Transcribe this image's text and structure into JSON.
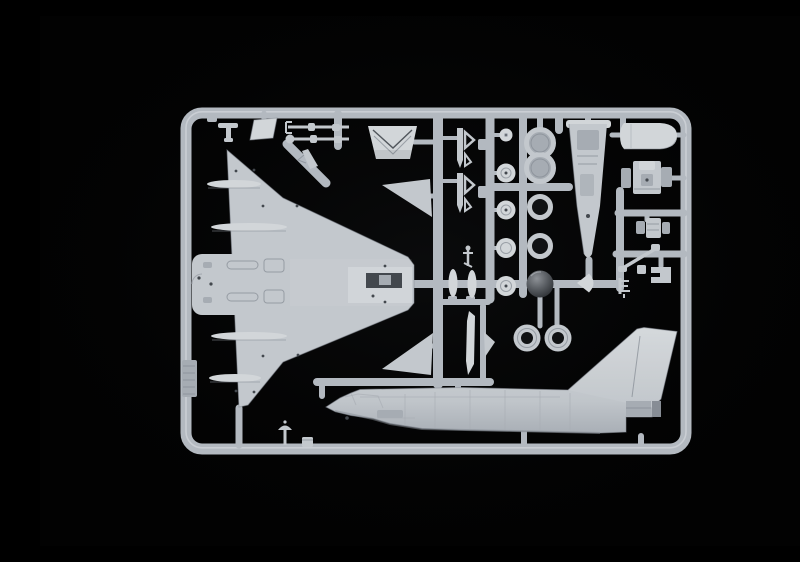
{
  "scene": {
    "description": "Macro photograph of a light grey injection-moulded plastic model-kit sprue (parts tree) for a delta-wing jet fighter, lying on a pitch-black studio background",
    "subject_hint": "Eurofighter-Typhoon-style kit sprue: delta wing lower half with belly detail, fuselage half with tall swept tail fin, two canard foreplanes, landing-gear wheels, intake rings, ejection seat, cockpit tub, nose cone and many small parts",
    "orientation": "rounded-rectangle sprue frame centred in image; wing at left, fuselage with fin along bottom right, small parts in columns at top right",
    "visible_text": "none"
  },
  "colors": {
    "bg": "#020202",
    "runner": "#b3b9c0",
    "runner_light": "#dde0e3",
    "plastic": "#c3c8cd",
    "plastic_bright": "#d2d6d9",
    "plastic_mid": "#a6acb3",
    "plastic_shadow": "#878d95",
    "recess": "#43484e",
    "hole": "#101214"
  },
  "parts": [
    {
      "name": "sprue-frame",
      "label": "rounded rectangular moulding-frame runner"
    },
    {
      "name": "wing",
      "label": "delta wing underside piece with centre-fuselage belly detail"
    },
    {
      "name": "fuselage",
      "label": "fuselage half with canopy, intake and tall swept tail fin"
    },
    {
      "name": "canard-upper",
      "label": "canard foreplane (upper)"
    },
    {
      "name": "canard-lower",
      "label": "canard foreplane (lower)"
    },
    {
      "name": "intake-scoop",
      "label": "air-intake scoop with chevron ridges"
    },
    {
      "name": "gear-strut-upper",
      "label": "landing-gear strut rod (upper)"
    },
    {
      "name": "gear-strut-lower",
      "label": "landing-gear strut rod (lower)"
    },
    {
      "name": "door-parallelogram",
      "label": "parallelogram gear-door panel"
    },
    {
      "name": "t-antenna",
      "label": "small T-shaped antenna part"
    },
    {
      "name": "dart-missile-upper",
      "label": "small missile body with open fin (upper)"
    },
    {
      "name": "dart-missile-lower",
      "label": "small missile body with open fin (lower)"
    },
    {
      "name": "wheel-column",
      "label": "column of five landing-gear wheel halves"
    },
    {
      "name": "ring-pair",
      "label": "pair of joined intake rings"
    },
    {
      "name": "ring-upper",
      "label": "hollow ring part (upper)"
    },
    {
      "name": "ring-lower",
      "label": "hollow ring part (lower)"
    },
    {
      "name": "radome-ball",
      "label": "dark glossy hemispherical radome part"
    },
    {
      "name": "tire-left",
      "label": "main-wheel tire with open hub (left)"
    },
    {
      "name": "tire-right",
      "label": "main-wheel tire with open hub (right)"
    },
    {
      "name": "cockpit-tub",
      "label": "long tapered cockpit tub / nose bay piece"
    },
    {
      "name": "nose-cone",
      "label": "rounded nose-cone half"
    },
    {
      "name": "ejection-seat",
      "label": "ejection seat with side consoles"
    },
    {
      "name": "seat-back-deck",
      "label": "small seat / rear cockpit deck part"
    },
    {
      "name": "gear-leg",
      "label": "thin diagonal gear-leg rod"
    },
    {
      "name": "ladder-f",
      "label": "tiny comb / ladder-shaped part"
    },
    {
      "name": "bracket",
      "label": "C-shaped bracket part"
    },
    {
      "name": "gear-door-lenses",
      "label": "pair of lens-shaped nose-gear doors"
    },
    {
      "name": "canopy-rail",
      "label": "slender canopy-rail blade"
    },
    {
      "name": "fin-small",
      "label": "small triangular fin part"
    },
    {
      "name": "pitot",
      "label": "pitot mast on bottom runner"
    },
    {
      "name": "stub-block",
      "label": "small block part on bottom runner"
    },
    {
      "name": "part-tag",
      "label": "ribbed identification tag on left runner"
    },
    {
      "name": "fairing-spindles",
      "label": "four spindle-shaped flap actuator fairings on wing"
    },
    {
      "name": "anchor-part",
      "label": "tiny anchor-shaped linkage"
    },
    {
      "name": "top-left-dart",
      "label": "small dart part on diagonal runner"
    },
    {
      "name": "teardrop-spinner",
      "label": "small teardrop spinner part"
    }
  ]
}
